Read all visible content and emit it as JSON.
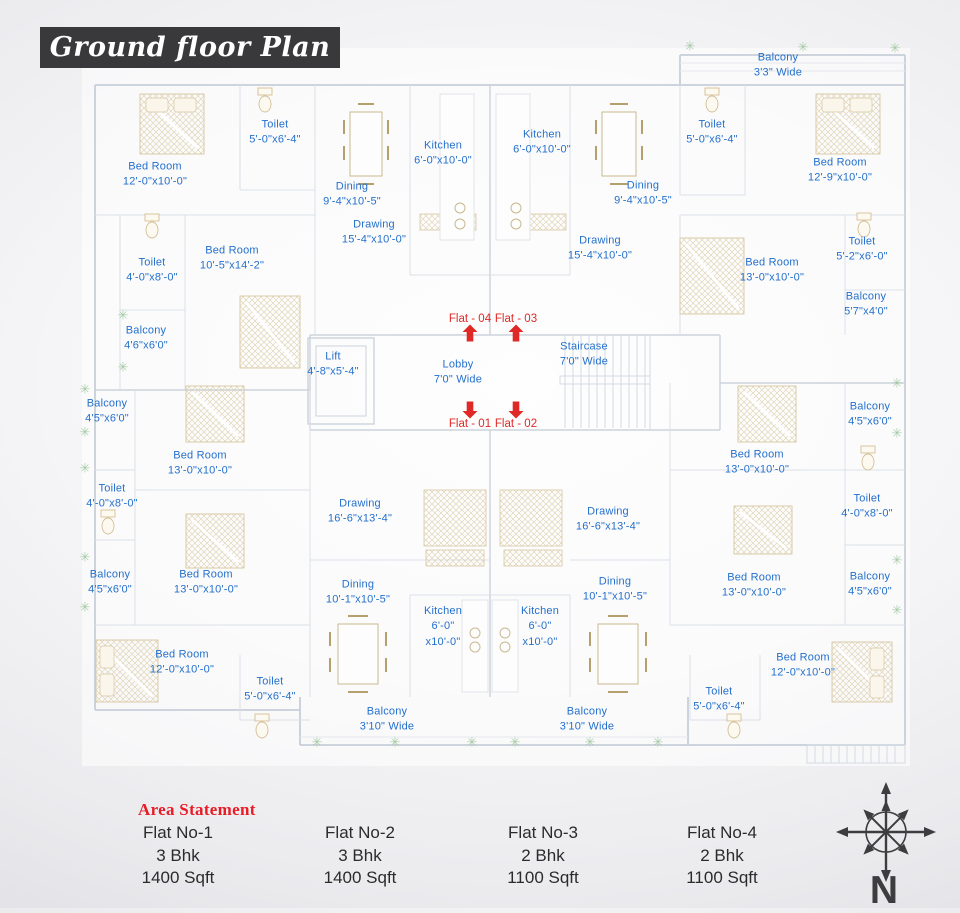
{
  "title": "Ground floor Plan",
  "colors": {
    "title_bg": "#39383a",
    "title_text": "#ffffff",
    "label_blue": "#2470cc",
    "marker_red": "#e02826",
    "heading_red": "#e81c26",
    "body_text": "#2b2b2b",
    "plant_green": "#96c296",
    "compass": "#3d3c3e"
  },
  "plan": {
    "rooms": [
      {
        "lines": [
          "Bed Room",
          "12'-0\"x10'-0\""
        ],
        "x": 155,
        "y": 175
      },
      {
        "lines": [
          "Toilet",
          "5'-0\"x6'-4\""
        ],
        "x": 275,
        "y": 133
      },
      {
        "lines": [
          "Kitchen",
          "6'-0\"x10'-0\""
        ],
        "x": 443,
        "y": 154
      },
      {
        "lines": [
          "Dining",
          "9'-4\"x10'-5\""
        ],
        "x": 352,
        "y": 195
      },
      {
        "lines": [
          "Drawing",
          "15'-4\"x10'-0\""
        ],
        "x": 374,
        "y": 233
      },
      {
        "lines": [
          "Bed Room",
          "10'-5\"x14'-2\""
        ],
        "x": 232,
        "y": 259
      },
      {
        "lines": [
          "Toilet",
          "4'-0\"x8'-0\""
        ],
        "x": 152,
        "y": 271
      },
      {
        "lines": [
          "Balcony",
          "4'6\"x6'0\""
        ],
        "x": 146,
        "y": 339
      },
      {
        "lines": [
          "Kitchen",
          "6'-0\"x10'-0\""
        ],
        "x": 542,
        "y": 143
      },
      {
        "lines": [
          "Dining",
          "9'-4\"x10'-5\""
        ],
        "x": 643,
        "y": 194
      },
      {
        "lines": [
          "Drawing",
          "15'-4\"x10'-0\""
        ],
        "x": 600,
        "y": 249
      },
      {
        "lines": [
          "Toilet",
          "5'-0\"x6'-4\""
        ],
        "x": 712,
        "y": 133
      },
      {
        "lines": [
          "Bed Room",
          "12'-9\"x10'-0\""
        ],
        "x": 840,
        "y": 171
      },
      {
        "lines": [
          "Bed Room",
          "13'-0\"x10'-0\""
        ],
        "x": 772,
        "y": 271
      },
      {
        "lines": [
          "Toilet",
          "5'-2\"x6'-0\""
        ],
        "x": 862,
        "y": 250
      },
      {
        "lines": [
          "Balcony",
          "5'7\"x4'0\""
        ],
        "x": 866,
        "y": 305
      },
      {
        "lines": [
          "Balcony",
          "3'3\" Wide"
        ],
        "x": 778,
        "y": 66
      },
      {
        "lines": [
          "Lift",
          "4'-8\"x5'-4\""
        ],
        "x": 333,
        "y": 365
      },
      {
        "lines": [
          "Lobby",
          "7'0\" Wide"
        ],
        "x": 458,
        "y": 373
      },
      {
        "lines": [
          "Staircase",
          "7'0\" Wide"
        ],
        "x": 584,
        "y": 355
      },
      {
        "lines": [
          "Balcony",
          "4'5\"x6'0\""
        ],
        "x": 107,
        "y": 412
      },
      {
        "lines": [
          "Bed Room",
          "13'-0\"x10'-0\""
        ],
        "x": 200,
        "y": 464
      },
      {
        "lines": [
          "Toilet",
          "4'-0\"x8'-0\""
        ],
        "x": 112,
        "y": 497
      },
      {
        "lines": [
          "Balcony",
          "4'5\"x6'0\""
        ],
        "x": 110,
        "y": 583
      },
      {
        "lines": [
          "Bed Room",
          "13'-0\"x10'-0\""
        ],
        "x": 206,
        "y": 583
      },
      {
        "lines": [
          "Bed Room",
          "12'-0\"x10'-0\""
        ],
        "x": 182,
        "y": 663
      },
      {
        "lines": [
          "Toilet",
          "5'-0\"x6'-4\""
        ],
        "x": 270,
        "y": 690
      },
      {
        "lines": [
          "Drawing",
          "16'-6\"x13'-4\""
        ],
        "x": 360,
        "y": 512
      },
      {
        "lines": [
          "Dining",
          "10'-1\"x10'-5\""
        ],
        "x": 358,
        "y": 593
      },
      {
        "lines": [
          "Kitchen",
          "6'-0\"",
          "x10'-0\""
        ],
        "x": 443,
        "y": 627
      },
      {
        "lines": [
          "Balcony",
          "3'10\" Wide"
        ],
        "x": 387,
        "y": 720
      },
      {
        "lines": [
          "Kitchen",
          "6'-0\"",
          "x10'-0\""
        ],
        "x": 540,
        "y": 627
      },
      {
        "lines": [
          "Dining",
          "10'-1\"x10'-5\""
        ],
        "x": 615,
        "y": 590
      },
      {
        "lines": [
          "Drawing",
          "16'-6\"x13'-4\""
        ],
        "x": 608,
        "y": 520
      },
      {
        "lines": [
          "Balcony",
          "3'10\" Wide"
        ],
        "x": 587,
        "y": 720
      },
      {
        "lines": [
          "Bed Room",
          "13'-0\"x10'-0\""
        ],
        "x": 757,
        "y": 463
      },
      {
        "lines": [
          "Balcony",
          "4'5\"x6'0\""
        ],
        "x": 870,
        "y": 415
      },
      {
        "lines": [
          "Toilet",
          "4'-0\"x8'-0\""
        ],
        "x": 867,
        "y": 507
      },
      {
        "lines": [
          "Bed Room",
          "13'-0\"x10'-0\""
        ],
        "x": 754,
        "y": 586
      },
      {
        "lines": [
          "Balcony",
          "4'5\"x6'0\""
        ],
        "x": 870,
        "y": 585
      },
      {
        "lines": [
          "Bed Room",
          "12'-0\"x10'-0\""
        ],
        "x": 803,
        "y": 666
      },
      {
        "lines": [
          "Toilet",
          "5'-0\"x6'-4\""
        ],
        "x": 719,
        "y": 700
      }
    ],
    "flat_markers": [
      {
        "label": "Flat - 04",
        "x": 470,
        "y": 319,
        "arrow_x": 470,
        "arrow_y": 333,
        "direction": "up"
      },
      {
        "label": "Flat - 03",
        "x": 516,
        "y": 319,
        "arrow_x": 516,
        "arrow_y": 333,
        "direction": "up"
      },
      {
        "label": "Flat - 01",
        "x": 470,
        "y": 424,
        "arrow_x": 470,
        "arrow_y": 410,
        "direction": "down"
      },
      {
        "label": "Flat - 02",
        "x": 516,
        "y": 424,
        "arrow_x": 516,
        "arrow_y": 410,
        "direction": "down"
      }
    ],
    "plant_icon": "✳",
    "plants": [
      {
        "x": 690,
        "y": 46
      },
      {
        "x": 803,
        "y": 47
      },
      {
        "x": 895,
        "y": 48
      },
      {
        "x": 123,
        "y": 315
      },
      {
        "x": 123,
        "y": 367
      },
      {
        "x": 85,
        "y": 389
      },
      {
        "x": 85,
        "y": 432
      },
      {
        "x": 85,
        "y": 468
      },
      {
        "x": 85,
        "y": 557
      },
      {
        "x": 85,
        "y": 607
      },
      {
        "x": 317,
        "y": 742
      },
      {
        "x": 395,
        "y": 742
      },
      {
        "x": 472,
        "y": 742
      },
      {
        "x": 515,
        "y": 742
      },
      {
        "x": 590,
        "y": 742
      },
      {
        "x": 658,
        "y": 742
      },
      {
        "x": 897,
        "y": 383
      },
      {
        "x": 897,
        "y": 433
      },
      {
        "x": 897,
        "y": 560
      },
      {
        "x": 897,
        "y": 610
      }
    ]
  },
  "area_statement": {
    "heading": "Area Statement",
    "flats": [
      {
        "name": "Flat No-1",
        "bhk": "3 Bhk",
        "area": "1400 Sqft",
        "x": 178
      },
      {
        "name": "Flat No-2",
        "bhk": "3 Bhk",
        "area": "1400 Sqft",
        "x": 360
      },
      {
        "name": "Flat No-3",
        "bhk": "2 Bhk",
        "area": "1100 Sqft",
        "x": 543
      },
      {
        "name": "Flat No-4",
        "bhk": "2 Bhk",
        "area": "1100 Sqft",
        "x": 722
      }
    ]
  },
  "compass": {
    "label": "N"
  }
}
